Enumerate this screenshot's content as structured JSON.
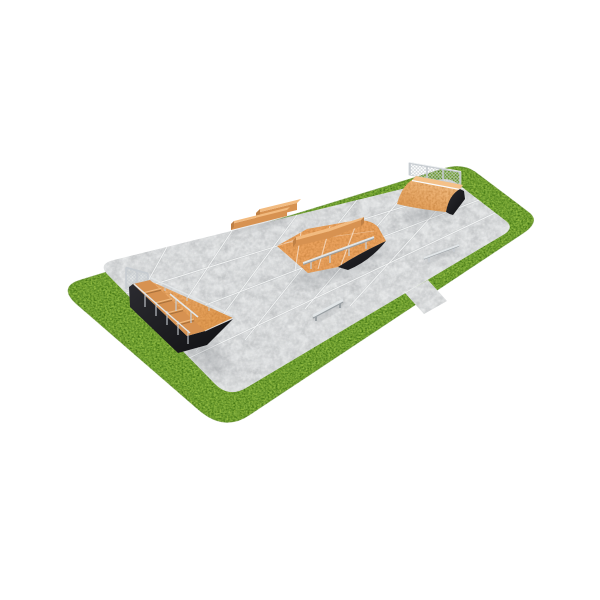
{
  "scene": {
    "title": "Skatepark 3D render",
    "description": "Isometric 3D render of a modular skatepark: a light concrete pad with expansion joints, surrounded by a green grass border with rounded corners, containing wooden skate obstacles with black sides and galvanized rails."
  },
  "colors": {
    "background": "#ffffff",
    "grass_base": "#7aa93a",
    "grass_edge": "#5a8526",
    "pad_concrete": "#dee0e1",
    "pad_seam": "#f4f5f6",
    "pad_seam_shadow": "#b4b8ba",
    "ramp_orange": "#eaa25e",
    "ramp_orange_light": "#f4c189",
    "ramp_orange_dark": "#d6954f",
    "wood_front": "#d79251",
    "wood_top": "#f2bb80",
    "wood_end": "#bf8045",
    "side_black": "#1d1d21",
    "metal_light": "#e2e6e8",
    "metal_mid": "#c6cbd0",
    "metal_dark": "#9aa0a4",
    "mesh": "#c6ccd0",
    "shadow": "#5c6166"
  },
  "objects": [
    {
      "id": "grass-field",
      "label": "Grass field with rounded corners"
    },
    {
      "id": "concrete-pad",
      "label": "Concrete pad with tile expansion joints"
    },
    {
      "id": "entry-path",
      "label": "Concrete entry path through the grass border"
    },
    {
      "id": "double-grind-box",
      "label": "Double wooden grind ledge / bench combo"
    },
    {
      "id": "funbox",
      "label": "Funbox with kinked ledge and grind rail"
    },
    {
      "id": "quarter-pipe",
      "label": "Quarter pipe with chain-link safety fence"
    },
    {
      "id": "round-grind-rail",
      "label": "Low round grind rail"
    },
    {
      "id": "flat-bar-rail",
      "label": "Low flat-bar grind rail"
    },
    {
      "id": "bank-ramp-with-stairs",
      "label": "Bank ramp with stairs, guard rails and chain-link fence"
    }
  ]
}
